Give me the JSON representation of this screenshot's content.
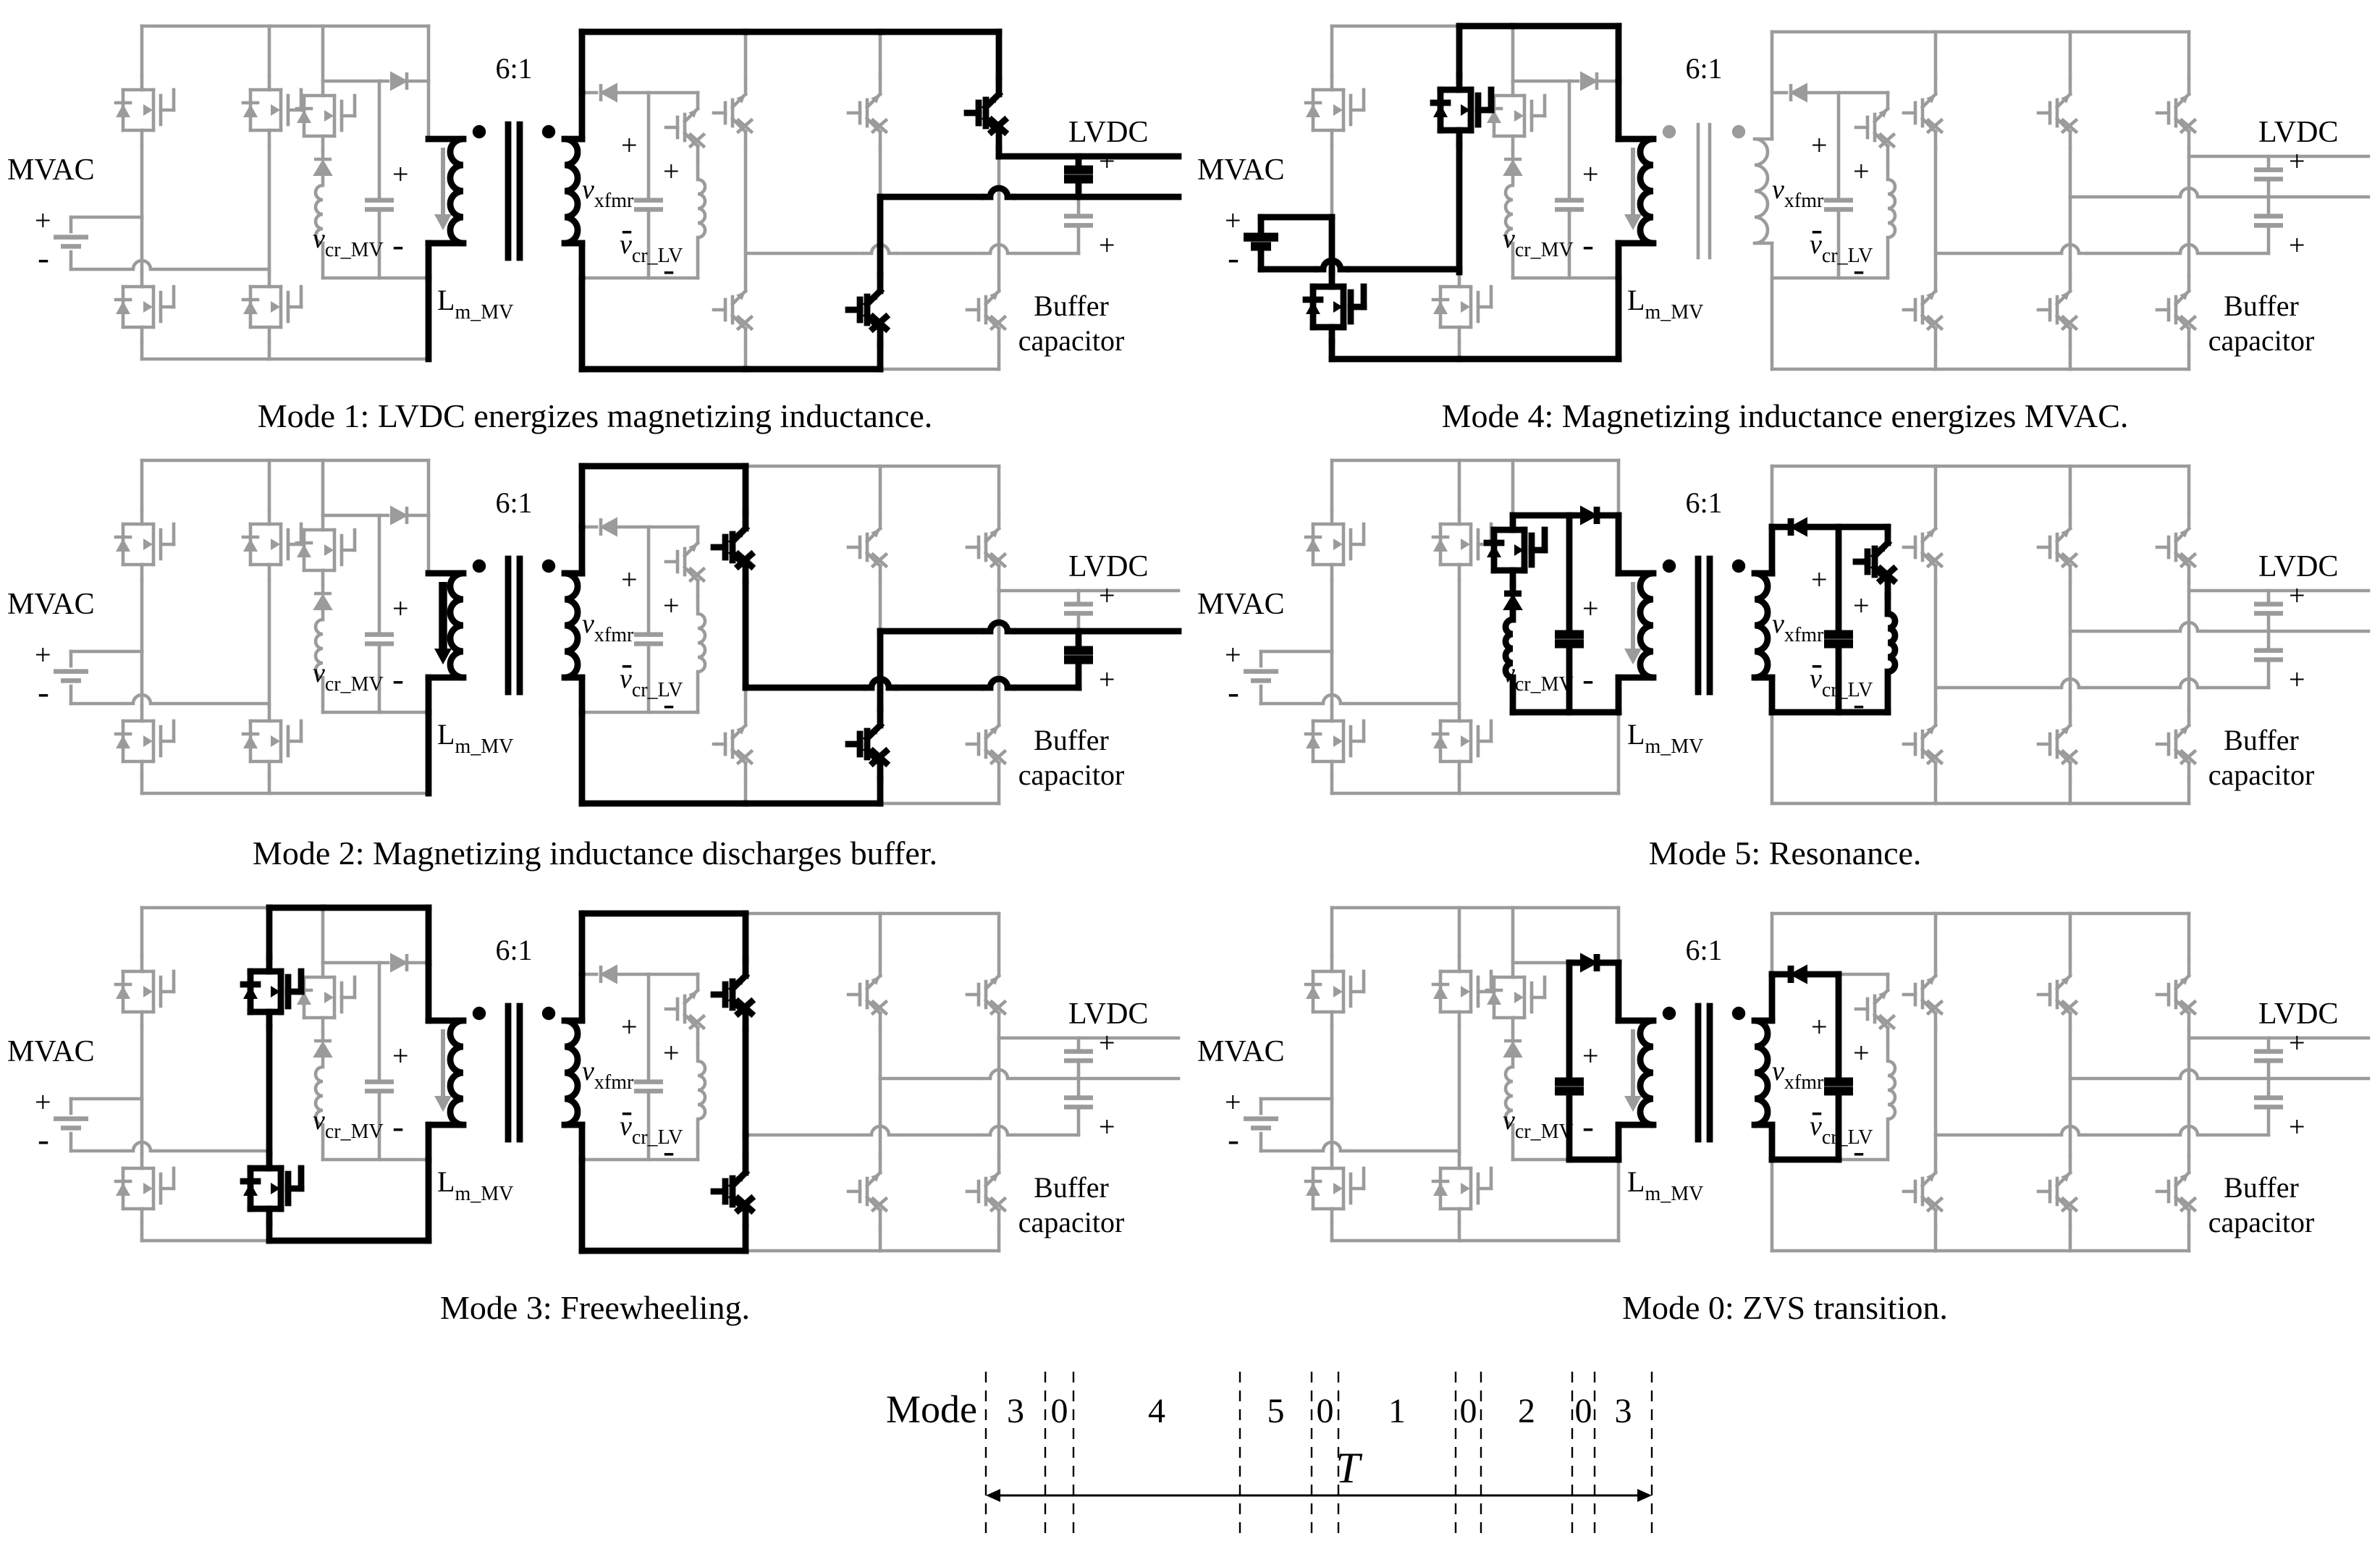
{
  "figure": {
    "panels": [
      {
        "key": "mode1",
        "caption": "Mode 1: LVDC energizes magnetizing inductance."
      },
      {
        "key": "mode4",
        "caption": "Mode 4: Magnetizing inductance energizes MVAC."
      },
      {
        "key": "mode2",
        "caption": "Mode 2: Magnetizing inductance discharges buffer."
      },
      {
        "key": "mode5",
        "caption": "Mode 5: Resonance."
      },
      {
        "key": "mode3",
        "caption": "Mode 3: Freewheeling."
      },
      {
        "key": "mode0",
        "caption": "Mode 0: ZVS transition."
      }
    ],
    "circuit_labels": {
      "mvac": "MVAC",
      "lvdc": "LVDC",
      "buffer_line1": "Buffer",
      "buffer_line2": "capacitor",
      "turns_ratio": "6:1",
      "v_cr_mv": {
        "main": "v",
        "sub": "cr_MV"
      },
      "v_cr_lv": {
        "main": "v",
        "sub": "cr_LV"
      },
      "v_xfmr": {
        "main": "v",
        "sub": "xfmr"
      },
      "l_m_mv": {
        "main": "L",
        "sub": "m_MV"
      },
      "plus": "+",
      "minus": "-"
    },
    "timing": {
      "label": "Mode",
      "sequence": [
        "3",
        "0",
        "4",
        "5",
        "0",
        "1",
        "0",
        "2",
        "0",
        "3"
      ],
      "period_label": "T"
    },
    "colors": {
      "active": "#000000",
      "inactive": "#9b9b9b"
    }
  }
}
